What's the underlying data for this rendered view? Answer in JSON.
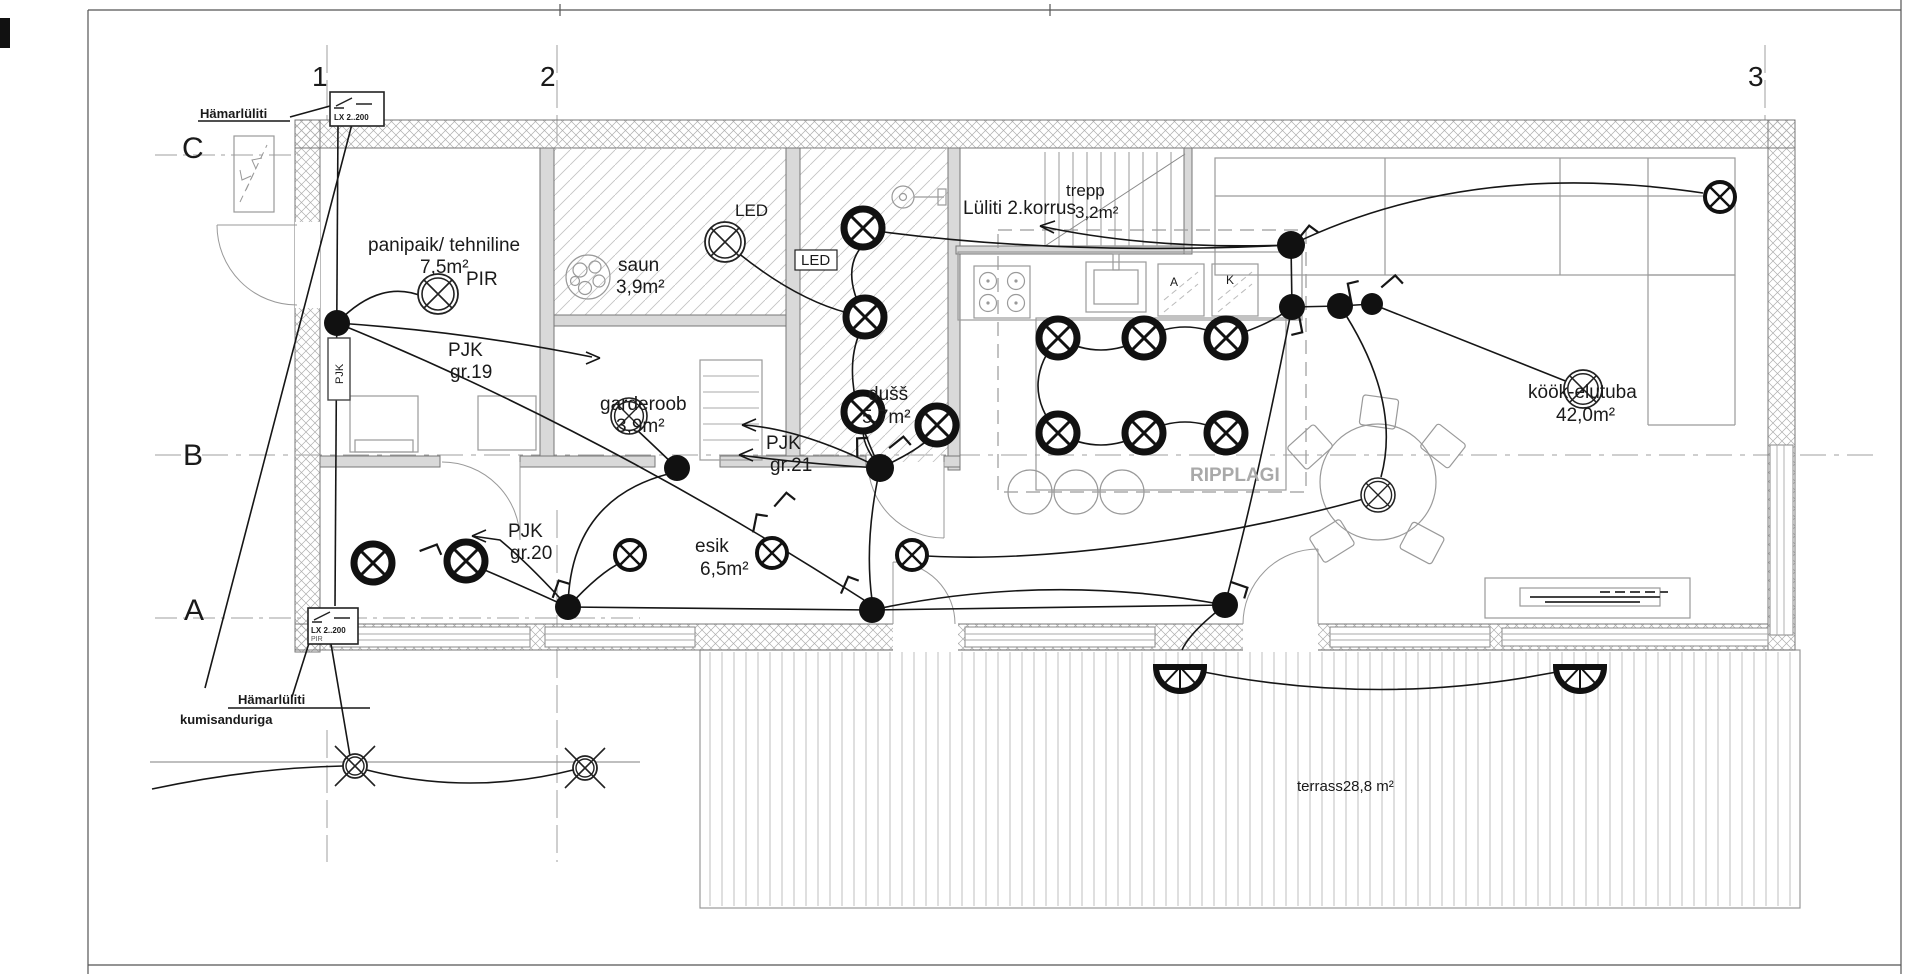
{
  "grid": {
    "col1": "1",
    "col2": "2",
    "col3": "3",
    "rowC": "C",
    "rowB": "B",
    "rowA": "A"
  },
  "rooms": {
    "panipaik": {
      "name": "panipaik/ tehniline",
      "area": "7,5m²"
    },
    "saun": {
      "name": "saun",
      "area": "3,9m²"
    },
    "trepp": {
      "name": "trepp",
      "area": "3,2m²"
    },
    "garderoob": {
      "name": "garderoob",
      "area": "3,9m²"
    },
    "dushsh": {
      "name": "dušš",
      "area": "5,7m²"
    },
    "esik": {
      "name": "esik",
      "area": "6,5m²"
    },
    "kook": {
      "name": "köök-elutuba",
      "area": "42,0m²"
    },
    "terrass": {
      "name": "terrass28,8 m²"
    }
  },
  "notes": {
    "pir": "PIR",
    "led": "LED",
    "led_boxed": "LED",
    "lyliti2": "Lüliti 2.korrus",
    "pjk19_1": "PJK",
    "pjk19_2": "gr.19",
    "pjk20_1": "PJK",
    "pjk20_2": "gr.20",
    "pjk21_1": "PJK",
    "pjk21_2": "gr.21",
    "ripplagi": "RIPPLAGI",
    "hamar_top": "Hämarlüliti",
    "hamar_bottom": "Hämarlüliti",
    "hamar_bottom2": "kumisanduriga",
    "lx_top": "LX 2..200",
    "lx_bottom": "LX 2..200",
    "lx_bottom_pir": "PIR",
    "appliance_a": "A",
    "appliance_k": "K",
    "pjk_box": "PJK"
  },
  "colors": {
    "line": "#1a1a1a",
    "wall_hatch": "#9a9a9a",
    "room_hatch": "#bdbdbd",
    "gray_text": "#a9a9a9"
  }
}
